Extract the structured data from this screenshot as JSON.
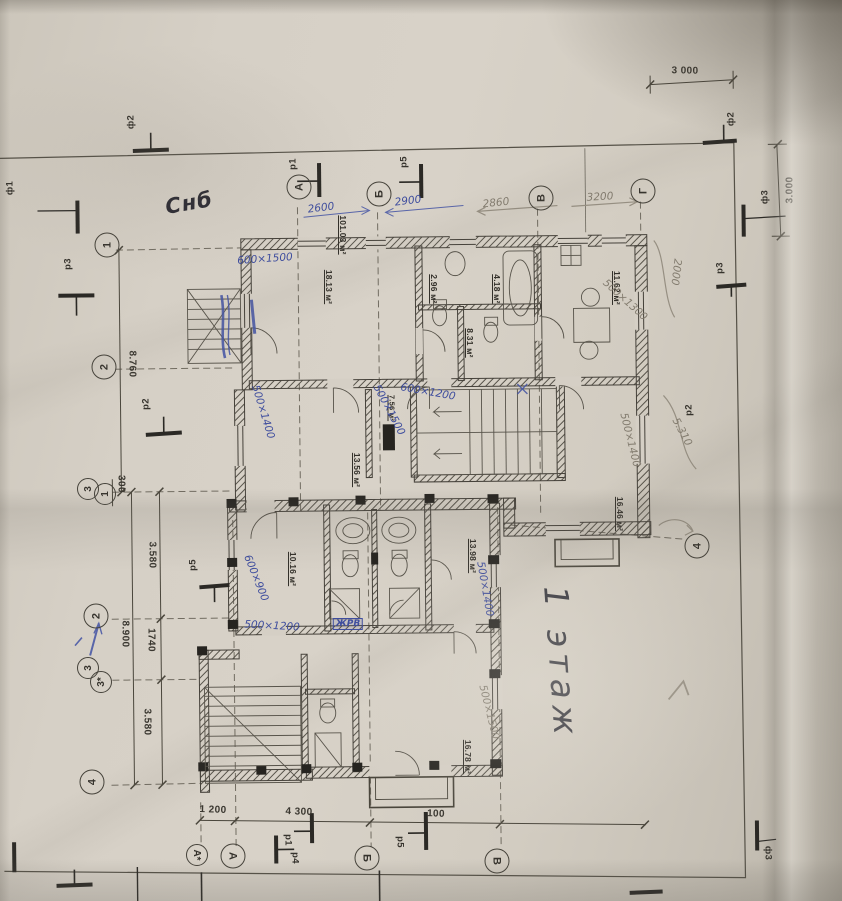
{
  "document": {
    "floor_label": "1 этаж",
    "corner_note": "Снб",
    "total_area": "101.03 м²"
  },
  "axis_bubbles": {
    "top": [
      "А",
      "Б",
      "В",
      "Г"
    ],
    "left_upper": [
      "1",
      "2",
      "3",
      "1"
    ],
    "left_lower": [
      "2",
      "3",
      "3*",
      "4"
    ],
    "right": [
      "4"
    ],
    "bottom": [
      "А*",
      "А",
      "Б",
      "В"
    ]
  },
  "markers": {
    "f1": "ф1",
    "f2_top": "ф2",
    "f2_right": "ф2",
    "f3_right": "ф3",
    "f3_bottom": "ф3",
    "p1_top": "р1",
    "p5_top": "р5",
    "p3_left": "р3",
    "p2_left": "р2",
    "p5_left": "р5",
    "p3_right": "р3",
    "p2_right": "р2",
    "p1_bottom": "р1",
    "p4_bottom": "р4",
    "p5_bottom": "р5"
  },
  "dims": {
    "top_width": "3 000",
    "right_height": "3.000",
    "left_span_upper": "8.760",
    "left_offset": "300",
    "left_3580_a": "3.580",
    "left_1740": "1740",
    "left_span_lower": "8.900",
    "left_3580_b": "3.580",
    "bottom_1200": "1 200",
    "bottom_4300": "4 300",
    "bottom_100": "100"
  },
  "rooms": {
    "r1813": "18.13 м²",
    "r296": "2.96 м²",
    "r418": "4.18 м²",
    "r1162": "11.62 м²",
    "r831": "8.31 м²",
    "r756": "7.56 м²",
    "r1356": "13.56 м²",
    "r1646": "16.46 м²",
    "r1016": "10.16 м²",
    "r1398": "13.98 м²",
    "r1678": "16.78 м²"
  },
  "handwritten": {
    "w600x1500": "600×1500",
    "d2600": "2600",
    "d2900": "2900",
    "d2860": "2860",
    "d3200": "3200",
    "d2000": "2000",
    "d5310": "5.310",
    "w500x1400a": "500×1400",
    "w500x1500a": "500×1500",
    "w600x1200": "600×1200",
    "w500x1300": "500×1300",
    "w500x1400b": "500×1400",
    "w600x900": "600×900",
    "w500x1200": "500×1200",
    "zhrv": "ЖРВ",
    "w500x1400c": "500×1400",
    "w500x1500b": "500×1500"
  }
}
